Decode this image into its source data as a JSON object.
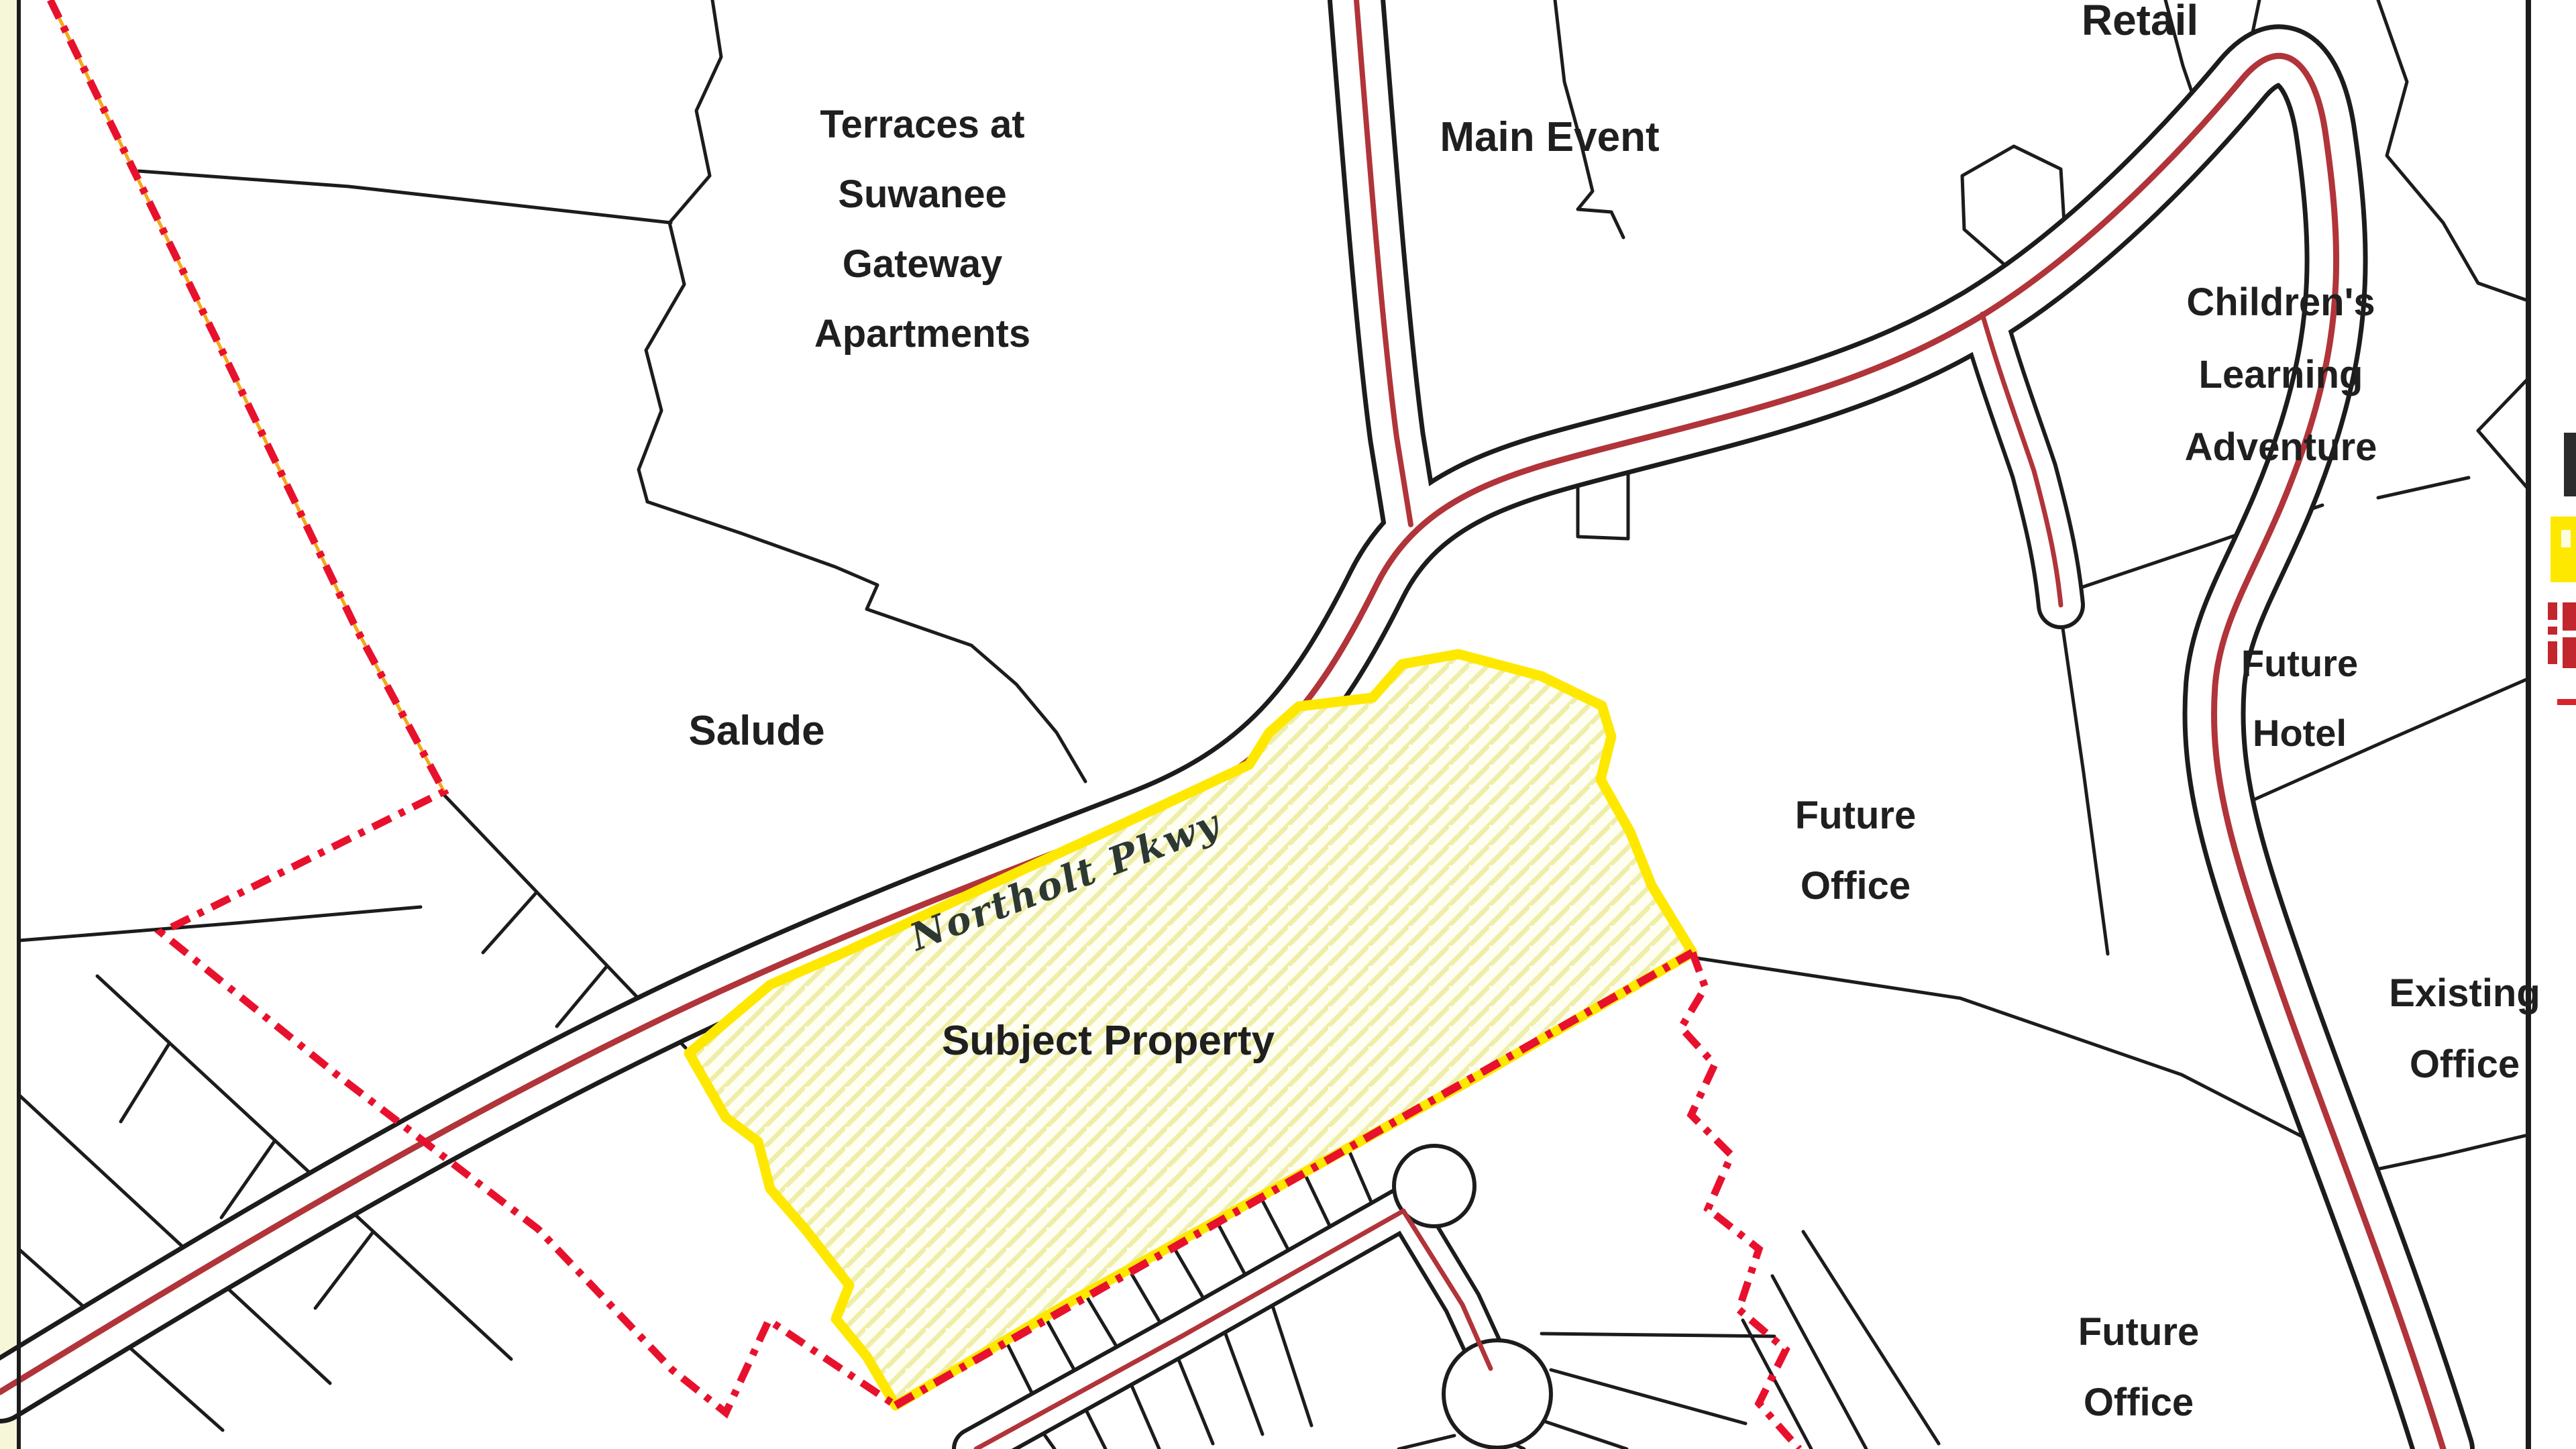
{
  "map": {
    "labels": {
      "retail": "Retail",
      "terraces": [
        "Terraces at",
        "Suwanee",
        "Gateway",
        "Apartments"
      ],
      "main_event": "Main Event",
      "childrens": [
        "Children's",
        "Learning",
        "Adventure"
      ],
      "future_hotel": [
        "Future",
        "Hotel"
      ],
      "salude": "Salude",
      "subject_property": "Subject Property",
      "future_office_center": [
        "Future",
        "Office"
      ],
      "existing_office": [
        "Existing",
        "Office"
      ],
      "future_office_south": [
        "Future",
        "Office"
      ],
      "road_name": "Northolt Pkwy"
    },
    "legend": {
      "items": [
        {
          "name": "black-square-swatch",
          "color": "#2b2b2b"
        },
        {
          "name": "subject-property-swatch",
          "color": "#ffe800"
        },
        {
          "name": "boundary-dash-swatch",
          "color": "#c1272d"
        },
        {
          "name": "road-line-swatch",
          "color": "#d8232a"
        }
      ]
    },
    "colors": {
      "parcel_line": "#1c1c1c",
      "road_centerline_red": "#b03439",
      "boundary_dash_red": "#e8112d",
      "boundary_underlay_orange": "#f5a81c",
      "subject_fill_yellow": "#ffe800",
      "hatch_yellow": "#eeeea8",
      "paper_margin": "#f6f6d8"
    }
  }
}
